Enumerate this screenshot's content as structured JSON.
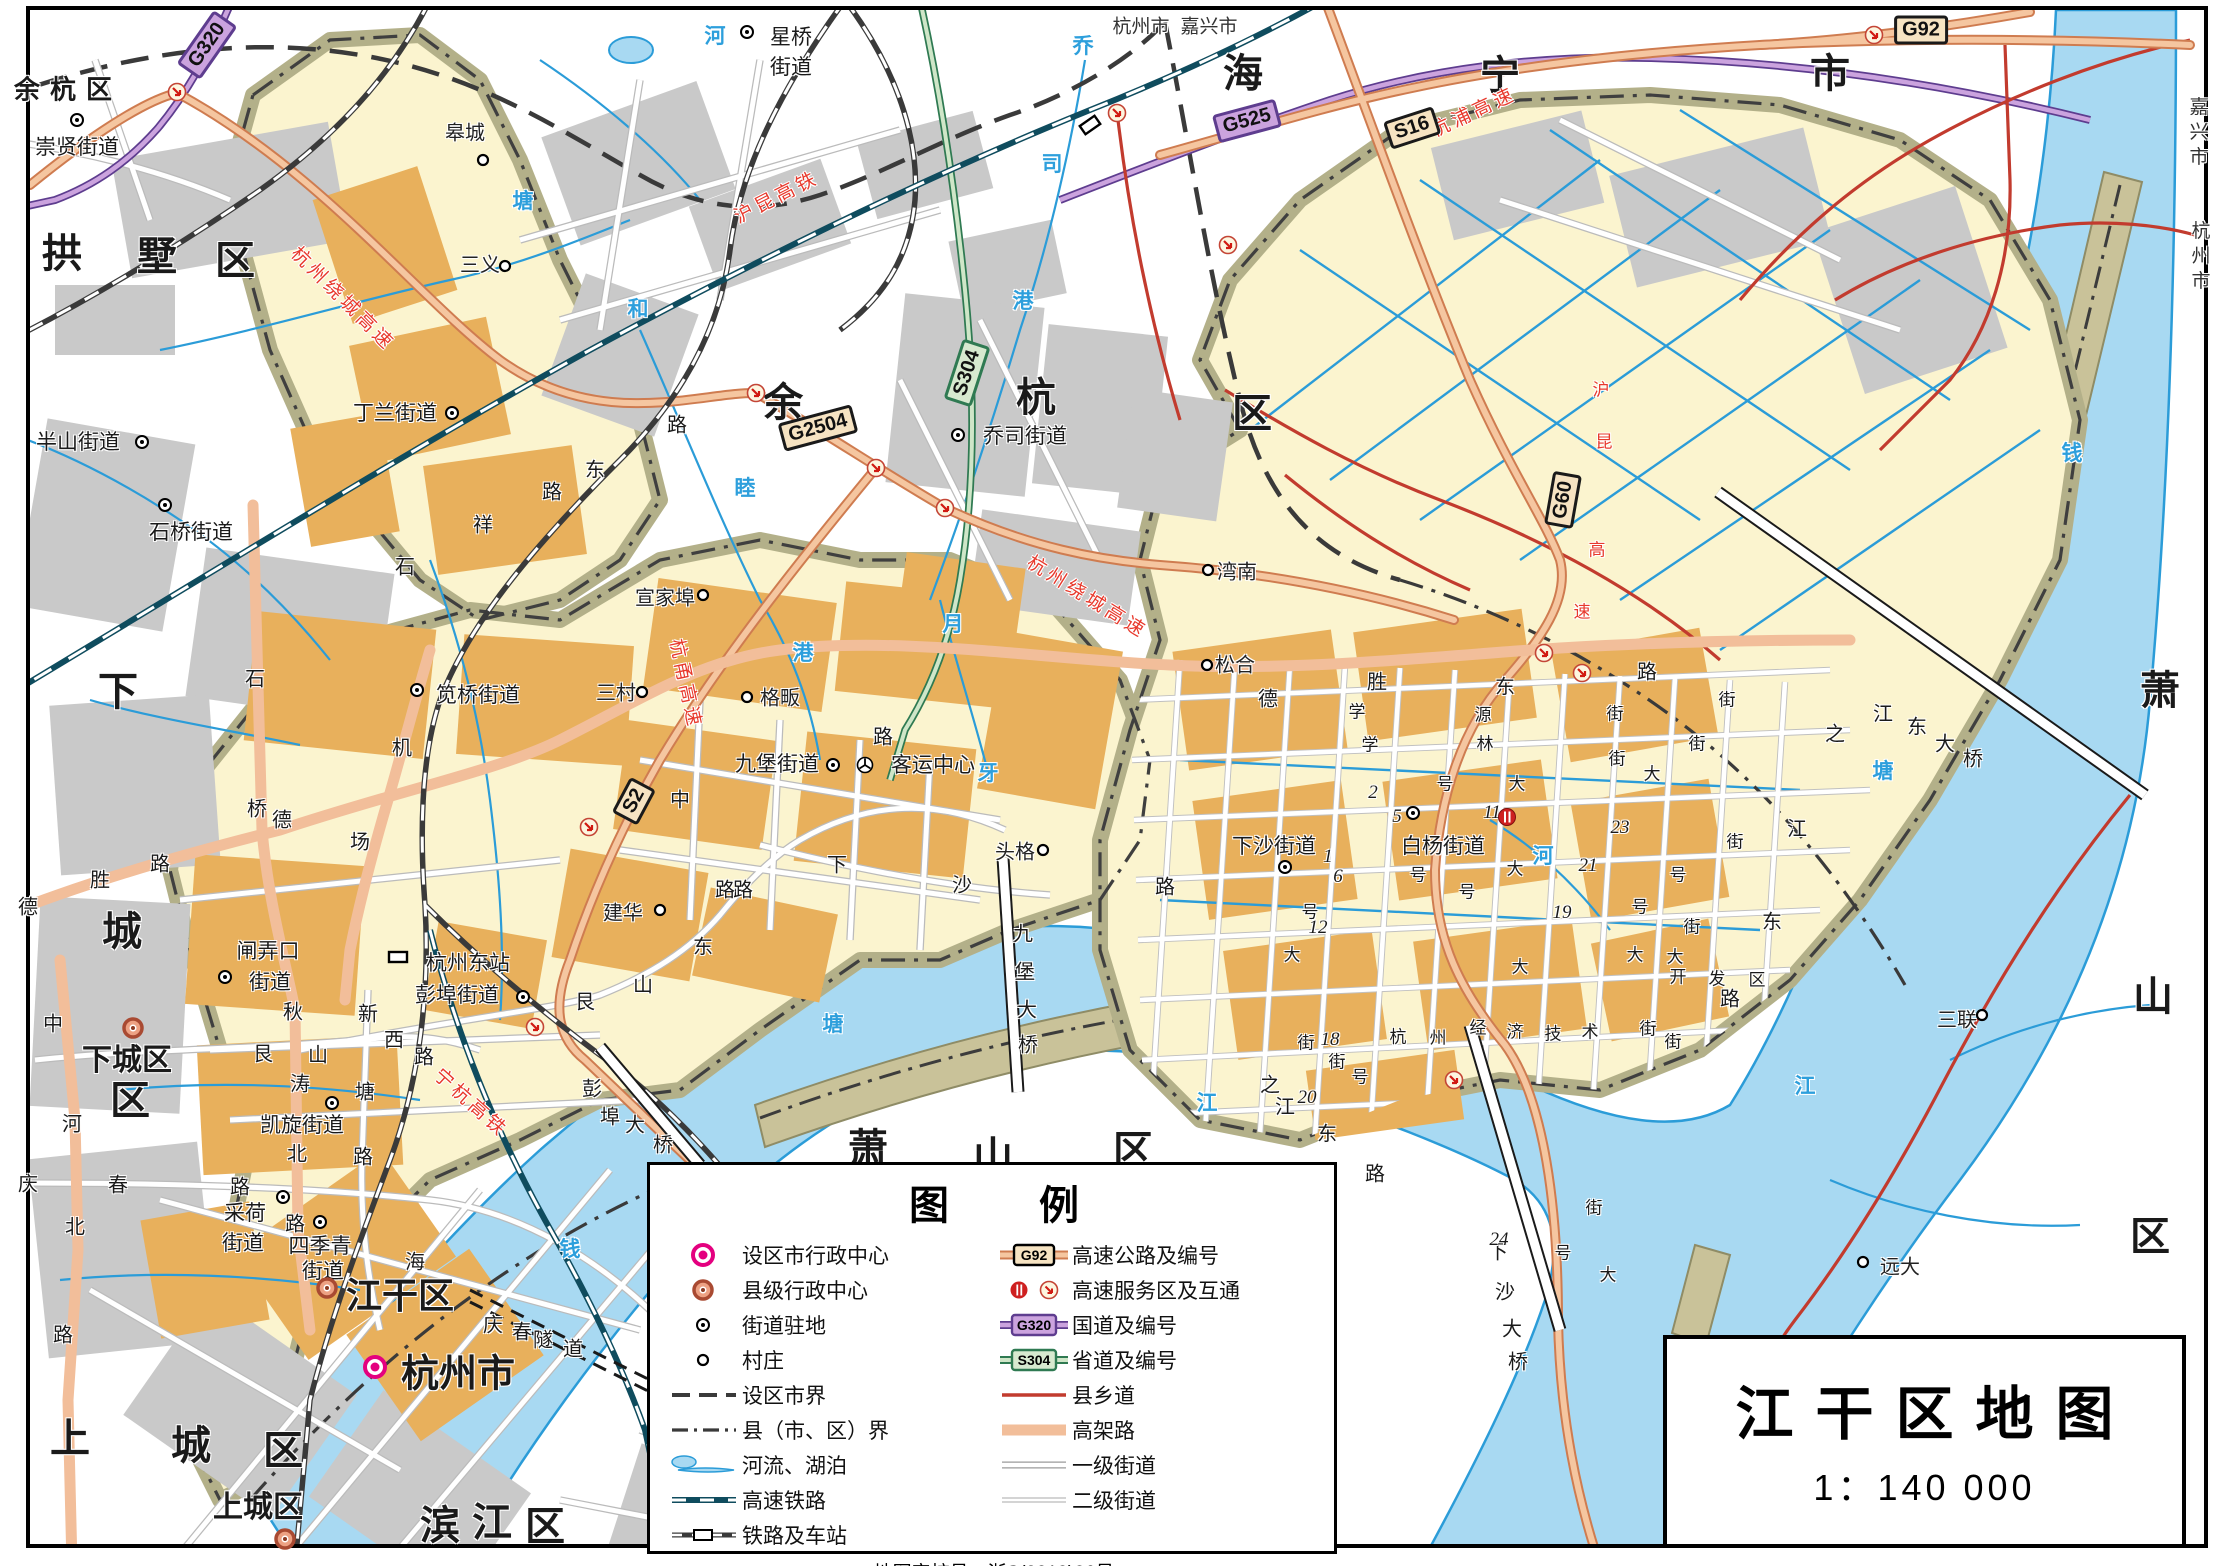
{
  "title_box": {
    "title": "江干区地图",
    "scale": "1：140 000"
  },
  "legend": {
    "title": "图例",
    "approval": "地图审核号：浙S(2019)36号",
    "left": [
      {
        "icon": "city-admin",
        "label": "设区市行政中心"
      },
      {
        "icon": "county-admin",
        "label": "县级行政中心"
      },
      {
        "icon": "subdistrict",
        "label": "街道驻地"
      },
      {
        "icon": "village",
        "label": "村庄"
      },
      {
        "icon": "city-boundary",
        "label": "设区市界"
      },
      {
        "icon": "county-boundary",
        "label": "县（市、区）界"
      },
      {
        "icon": "river",
        "label": "河流、湖泊"
      },
      {
        "icon": "hsr",
        "label": "高速铁路"
      },
      {
        "icon": "railway",
        "label": "铁路及车站"
      }
    ],
    "right": [
      {
        "icon": "expressway",
        "label": "高速公路及编号",
        "shield": "G92"
      },
      {
        "icon": "service",
        "label": "高速服务区及互通"
      },
      {
        "icon": "national",
        "label": "国道及编号",
        "shield": "G320"
      },
      {
        "icon": "provincial",
        "label": "省道及编号",
        "shield": "S304"
      },
      {
        "icon": "county-road",
        "label": "县乡道"
      },
      {
        "icon": "elevated",
        "label": "高架路"
      },
      {
        "icon": "street1",
        "label": "一级街道"
      },
      {
        "icon": "street2",
        "label": "二级街道"
      }
    ]
  },
  "shields": [
    [
      "G320",
      207,
      45,
      -55,
      "nat"
    ],
    [
      "G525",
      1247,
      121,
      -15,
      "nat"
    ],
    [
      "S16",
      1412,
      128,
      -18,
      "exp"
    ],
    [
      "G92",
      1921,
      30,
      0,
      "exp"
    ],
    [
      "G2504",
      818,
      428,
      -15,
      "exp"
    ],
    [
      "S304",
      967,
      373,
      -72,
      "prov"
    ],
    [
      "S2",
      634,
      801,
      -62,
      "exp"
    ],
    [
      "G60",
      1563,
      500,
      -80,
      "exp"
    ]
  ],
  "labels": [
    [
      "余杭区",
      68,
      88,
      "d1",
      0
    ],
    [
      "拱",
      62,
      250,
      "dch",
      0
    ],
    [
      "墅",
      157,
      253,
      "dch",
      0
    ],
    [
      "区",
      235,
      257,
      "dch",
      0
    ],
    [
      "余",
      783,
      399,
      "dch",
      0
    ],
    [
      "杭",
      1036,
      394,
      "dch",
      0
    ],
    [
      "区",
      1252,
      410,
      "dch",
      0
    ],
    [
      "海",
      1243,
      70,
      "dch",
      0
    ],
    [
      "宁",
      1500,
      72,
      "dch",
      0
    ],
    [
      "市",
      1830,
      70,
      "dch",
      0
    ],
    [
      "下",
      118,
      688,
      "dch",
      0
    ],
    [
      "城",
      122,
      928,
      "dch",
      0
    ],
    [
      "区",
      130,
      1097,
      "dch",
      0
    ],
    [
      "上",
      70,
      1435,
      "dch",
      0
    ],
    [
      "城",
      191,
      1442,
      "dch",
      0
    ],
    [
      "区",
      283,
      1447,
      "dch",
      0
    ],
    [
      "滨",
      440,
      1522,
      "dch",
      0
    ],
    [
      "江",
      492,
      1519,
      "dch",
      0
    ],
    [
      "区",
      545,
      1523,
      "dch",
      0
    ],
    [
      "萧",
      868,
      1145,
      "dch",
      0
    ],
    [
      "山",
      993,
      1153,
      "dch",
      0
    ],
    [
      "区",
      1133,
      1147,
      "dch",
      0
    ],
    [
      "萧",
      2160,
      687,
      "dch",
      0
    ],
    [
      "山",
      2153,
      993,
      "dch",
      0
    ],
    [
      "区",
      2150,
      1233,
      "dch",
      0
    ],
    [
      "杭州市",
      1141,
      25,
      "bdy",
      0
    ],
    [
      "嘉兴市",
      1209,
      25,
      "bdy",
      0
    ],
    [
      "嘉兴市",
      2197,
      134,
      "bdyv",
      0
    ],
    [
      "杭州市",
      2199,
      258,
      "bdyv",
      0
    ],
    [
      "下城区",
      127,
      1057,
      "adm28",
      0
    ],
    [
      "江干区",
      400,
      1293,
      "adm34",
      0
    ],
    [
      "杭州市",
      458,
      1370,
      "adm36",
      0
    ],
    [
      "上城区",
      258,
      1504,
      "adm28",
      0
    ],
    [
      "崇贤街道",
      77,
      146,
      "town",
      0
    ],
    [
      "星桥",
      791,
      36,
      "town",
      0
    ],
    [
      "街道",
      791,
      66,
      "town",
      0
    ],
    [
      "半山街道",
      78,
      441,
      "town",
      0
    ],
    [
      "石桥街道",
      191,
      531,
      "town",
      0
    ],
    [
      "丁兰街道",
      395,
      412,
      "town",
      0
    ],
    [
      "乔司街道",
      1025,
      435,
      "town",
      0
    ],
    [
      "笕桥街道",
      478,
      694,
      "town",
      0
    ],
    [
      "九堡街道",
      777,
      763,
      "town",
      0
    ],
    [
      "客运中心",
      933,
      764,
      "town",
      0
    ],
    [
      "杭州东站",
      468,
      962,
      "town",
      0
    ],
    [
      "彭埠街道",
      457,
      994,
      "town",
      0
    ],
    [
      "闸弄口",
      268,
      950,
      "town",
      0
    ],
    [
      "街道",
      270,
      981,
      "town",
      0
    ],
    [
      "凯旋街道",
      302,
      1124,
      "town",
      0
    ],
    [
      "采荷",
      245,
      1212,
      "town",
      0
    ],
    [
      "街道",
      243,
      1242,
      "town",
      0
    ],
    [
      "四季青",
      320,
      1245,
      "town",
      0
    ],
    [
      "街道",
      323,
      1270,
      "town",
      0
    ],
    [
      "下沙街道",
      1274,
      845,
      "town",
      0
    ],
    [
      "白杨街道",
      1443,
      845,
      "town",
      0
    ],
    [
      "皋城",
      465,
      131,
      "vill",
      0
    ],
    [
      "三义",
      480,
      263,
      "vill",
      0
    ],
    [
      "宣家埠",
      665,
      596,
      "vill",
      0
    ],
    [
      "三村",
      616,
      691,
      "vill",
      0
    ],
    [
      "格畈",
      780,
      696,
      "vill",
      0
    ],
    [
      "头格",
      1015,
      850,
      "vill",
      0
    ],
    [
      "建华",
      623,
      911,
      "vill",
      0
    ],
    [
      "湾南",
      1237,
      570,
      "vill",
      0
    ],
    [
      "松合",
      1235,
      663,
      "vill",
      0
    ],
    [
      "三联",
      1957,
      1018,
      "vill",
      0
    ],
    [
      "远大",
      1900,
      1265,
      "vill",
      0
    ],
    [
      "德",
      28,
      905,
      "road",
      0
    ],
    [
      "胜",
      100,
      878,
      "road",
      0
    ],
    [
      "路",
      160,
      862,
      "road",
      0
    ],
    [
      "石",
      255,
      677,
      "road",
      0
    ],
    [
      "桥",
      257,
      807,
      "road",
      0
    ],
    [
      "石",
      405,
      565,
      "road",
      0
    ],
    [
      "祥",
      483,
      523,
      "road",
      0
    ],
    [
      "路",
      552,
      490,
      "road",
      0
    ],
    [
      "机",
      402,
      746,
      "road",
      0
    ],
    [
      "场",
      360,
      840,
      "road",
      0
    ],
    [
      "德",
      282,
      818,
      "road",
      0
    ],
    [
      "路",
      677,
      423,
      "road",
      0
    ],
    [
      "东",
      595,
      468,
      "road",
      0
    ],
    [
      "中",
      53,
      1022,
      "road",
      0
    ],
    [
      "河",
      72,
      1122,
      "road",
      0
    ],
    [
      "北",
      75,
      1225,
      "road",
      0
    ],
    [
      "路",
      63,
      1333,
      "road",
      0
    ],
    [
      "庆",
      28,
      1182,
      "road",
      0
    ],
    [
      "春",
      118,
      1183,
      "road",
      0
    ],
    [
      "路",
      240,
      1185,
      "road",
      0
    ],
    [
      "艮",
      263,
      1052,
      "road",
      0
    ],
    [
      "山",
      318,
      1053,
      "road",
      0
    ],
    [
      "西",
      394,
      1038,
      "road",
      0
    ],
    [
      "路",
      424,
      1055,
      "road",
      0
    ],
    [
      "新",
      368,
      1012,
      "road",
      0
    ],
    [
      "塘",
      365,
      1090,
      "road",
      0
    ],
    [
      "路",
      363,
      1155,
      "road",
      0
    ],
    [
      "秋",
      293,
      1010,
      "road",
      0
    ],
    [
      "涛",
      300,
      1082,
      "road",
      0
    ],
    [
      "北",
      297,
      1152,
      "road",
      0
    ],
    [
      "路",
      295,
      1222,
      "road",
      0
    ],
    [
      "海",
      415,
      1260,
      "road",
      0
    ],
    [
      "艮",
      585,
      1000,
      "road",
      0
    ],
    [
      "山",
      643,
      983,
      "road",
      0
    ],
    [
      "东",
      703,
      945,
      "road",
      0
    ],
    [
      "路",
      743,
      888,
      "road",
      0
    ],
    [
      "中",
      680,
      798,
      "road",
      0
    ],
    [
      "路",
      725,
      888,
      "road",
      0
    ],
    [
      "路",
      883,
      735,
      "road",
      0
    ],
    [
      "下",
      837,
      863,
      "road",
      0
    ],
    [
      "沙",
      962,
      883,
      "road",
      0
    ],
    [
      "德",
      1268,
      697,
      "road",
      0
    ],
    [
      "胜",
      1377,
      680,
      "road",
      0
    ],
    [
      "东",
      1505,
      685,
      "road",
      0
    ],
    [
      "路",
      1647,
      670,
      "road",
      0
    ],
    [
      "学",
      1357,
      710,
      "rs",
      0
    ],
    [
      "源",
      1483,
      713,
      "rs",
      0
    ],
    [
      "街",
      1615,
      712,
      "rs",
      0
    ],
    [
      "学",
      1370,
      743,
      "rs",
      0
    ],
    [
      "林",
      1485,
      742,
      "rs",
      0
    ],
    [
      "街",
      1617,
      757,
      "rs",
      0
    ],
    [
      "路",
      1165,
      885,
      "road",
      0
    ],
    [
      "九",
      1023,
      932,
      "road",
      0
    ],
    [
      "堡",
      1025,
      970,
      "road",
      0
    ],
    [
      "大",
      1027,
      1008,
      "road",
      0
    ],
    [
      "桥",
      1028,
      1043,
      "road",
      0
    ],
    [
      "彭",
      592,
      1087,
      "road",
      0
    ],
    [
      "埠",
      610,
      1115,
      "road",
      0
    ],
    [
      "大",
      635,
      1123,
      "road",
      0
    ],
    [
      "桥",
      663,
      1143,
      "road",
      0
    ],
    [
      "庆",
      493,
      1323,
      "road",
      0
    ],
    [
      "春",
      522,
      1330,
      "road",
      0
    ],
    [
      "隧",
      543,
      1338,
      "road",
      0
    ],
    [
      "道",
      573,
      1347,
      "road",
      0
    ],
    [
      "下",
      1498,
      1250,
      "road",
      0
    ],
    [
      "沙",
      1505,
      1290,
      "road",
      0
    ],
    [
      "大",
      1512,
      1327,
      "road",
      0
    ],
    [
      "桥",
      1518,
      1360,
      "road",
      0
    ],
    [
      "江",
      1883,
      712,
      "road",
      0
    ],
    [
      "东",
      1917,
      725,
      "road",
      0
    ],
    [
      "大",
      1945,
      742,
      "road",
      0
    ],
    [
      "桥",
      1973,
      757,
      "road",
      0
    ],
    [
      "之",
      1270,
      1083,
      "road",
      0
    ],
    [
      "江",
      1285,
      1105,
      "road",
      0
    ],
    [
      "东",
      1327,
      1132,
      "road",
      0
    ],
    [
      "路",
      1375,
      1172,
      "road",
      0
    ],
    [
      "之",
      1835,
      732,
      "road",
      0
    ],
    [
      "江",
      1797,
      827,
      "road",
      0
    ],
    [
      "东",
      1772,
      920,
      "road",
      0
    ],
    [
      "路",
      1730,
      997,
      "road",
      0
    ],
    [
      "杭",
      1398,
      1035,
      "rs",
      0
    ],
    [
      "州",
      1438,
      1036,
      "rs",
      0
    ],
    [
      "经",
      1478,
      1026,
      "rs",
      0
    ],
    [
      "济",
      1515,
      1030,
      "rs",
      0
    ],
    [
      "技",
      1553,
      1032,
      "rs",
      0
    ],
    [
      "术",
      1590,
      1030,
      "rs",
      0
    ],
    [
      "开",
      1678,
      975,
      "rs",
      0
    ],
    [
      "发",
      1717,
      977,
      "rs",
      0
    ],
    [
      "区",
      1757,
      978,
      "rs",
      0
    ],
    [
      "2",
      1373,
      793,
      "num",
      0
    ],
    [
      "5",
      1397,
      817,
      "num",
      0
    ],
    [
      "1",
      1328,
      857,
      "num",
      0
    ],
    [
      "6",
      1338,
      877,
      "num",
      0
    ],
    [
      "11",
      1492,
      813,
      "num",
      0
    ],
    [
      "12",
      1318,
      928,
      "num",
      0
    ],
    [
      "18",
      1330,
      1040,
      "num",
      0
    ],
    [
      "19",
      1562,
      913,
      "num",
      0
    ],
    [
      "20",
      1307,
      1098,
      "num",
      0
    ],
    [
      "21",
      1588,
      866,
      "num",
      0
    ],
    [
      "23",
      1620,
      828,
      "num",
      0
    ],
    [
      "24",
      1499,
      1240,
      "num",
      0
    ],
    [
      "号",
      1445,
      782,
      "rs",
      0
    ],
    [
      "大",
      1517,
      782,
      "rs",
      0
    ],
    [
      "号",
      1418,
      873,
      "rs",
      0
    ],
    [
      "号",
      1467,
      890,
      "rs",
      0
    ],
    [
      "大",
      1515,
      867,
      "rs",
      0
    ],
    [
      "号",
      1310,
      910,
      "rs",
      0
    ],
    [
      "大",
      1292,
      953,
      "rs",
      0
    ],
    [
      "大",
      1520,
      965,
      "rs",
      0
    ],
    [
      "街",
      1306,
      1041,
      "rs",
      0
    ],
    [
      "街",
      1337,
      1060,
      "rs",
      0
    ],
    [
      "号",
      1360,
      1075,
      "rs",
      0
    ],
    [
      "大",
      1652,
      772,
      "rs",
      0
    ],
    [
      "街",
      1727,
      698,
      "rs",
      0
    ],
    [
      "街",
      1697,
      742,
      "rs",
      0
    ],
    [
      "街",
      1735,
      840,
      "rs",
      0
    ],
    [
      "号",
      1678,
      873,
      "rs",
      0
    ],
    [
      "号",
      1640,
      905,
      "rs",
      0
    ],
    [
      "街",
      1692,
      925,
      "rs",
      0
    ],
    [
      "大",
      1635,
      953,
      "rs",
      0
    ],
    [
      "大",
      1675,
      955,
      "rs",
      0
    ],
    [
      "街",
      1648,
      1027,
      "rs",
      0
    ],
    [
      "街",
      1673,
      1040,
      "rs",
      0
    ],
    [
      "号",
      1563,
      1251,
      "rs",
      0
    ],
    [
      "大",
      1608,
      1273,
      "rs",
      0
    ],
    [
      "街",
      1594,
      1206,
      "rs",
      0
    ],
    [
      "河",
      715,
      35,
      "wat",
      0
    ],
    [
      "乔",
      1083,
      45,
      "wat",
      0
    ],
    [
      "司",
      1052,
      163,
      "wat",
      0
    ],
    [
      "港",
      1023,
      300,
      "wat",
      0
    ],
    [
      "塘",
      523,
      200,
      "wat",
      0
    ],
    [
      "和",
      638,
      308,
      "wat",
      0
    ],
    [
      "睦",
      745,
      487,
      "wat",
      0
    ],
    [
      "港",
      803,
      652,
      "wat",
      0
    ],
    [
      "月",
      953,
      623,
      "wat",
      0
    ],
    [
      "牙",
      988,
      772,
      "wat",
      0
    ],
    [
      "河",
      1543,
      855,
      "wat",
      0
    ],
    [
      "钱",
      570,
      1248,
      "wat",
      0
    ],
    [
      "塘",
      833,
      1023,
      "wat",
      0
    ],
    [
      "江",
      1207,
      1102,
      "wat",
      0
    ],
    [
      "钱",
      2072,
      452,
      "wat",
      0
    ],
    [
      "塘",
      1883,
      770,
      "wat",
      0
    ],
    [
      "江",
      1805,
      1085,
      "wat",
      0
    ],
    [
      "杭州绕城高速",
      344,
      298,
      "redl",
      45
    ],
    [
      "杭甬高速",
      687,
      684,
      "redl",
      78
    ],
    [
      "杭州绕城高速",
      1088,
      596,
      "redl",
      32
    ],
    [
      "沪昆高铁",
      776,
      196,
      "redl",
      -27
    ],
    [
      "宁杭高铁",
      472,
      1102,
      "redl",
      42
    ],
    [
      "杭浦高速",
      1473,
      111,
      "redl",
      -25
    ],
    [
      "沪",
      1601,
      388,
      "red",
      0
    ],
    [
      "昆",
      1604,
      440,
      "red",
      0
    ],
    [
      "高",
      1597,
      548,
      "red",
      0
    ],
    [
      "速",
      1582,
      610,
      "red",
      0
    ]
  ],
  "markers": [
    [
      "city",
      375,
      1367,
      0
    ],
    [
      "county",
      133,
      1028,
      0
    ],
    [
      "county",
      327,
      1288,
      0
    ],
    [
      "county",
      285,
      1539,
      0
    ],
    [
      "town",
      77,
      120,
      0
    ],
    [
      "town",
      747,
      32,
      0
    ],
    [
      "town",
      142,
      442,
      0
    ],
    [
      "town",
      165,
      505,
      0
    ],
    [
      "town",
      452,
      413,
      0
    ],
    [
      "town",
      958,
      435,
      0
    ],
    [
      "town",
      417,
      690,
      0
    ],
    [
      "town",
      833,
      765,
      0
    ],
    [
      "town",
      523,
      997,
      0
    ],
    [
      "town",
      225,
      977,
      0
    ],
    [
      "town",
      332,
      1103,
      0
    ],
    [
      "town",
      283,
      1197,
      0
    ],
    [
      "town",
      320,
      1222,
      0
    ],
    [
      "town",
      1285,
      867,
      0
    ],
    [
      "town",
      1413,
      813,
      0
    ],
    [
      "village",
      483,
      160,
      0
    ],
    [
      "village",
      505,
      266,
      0
    ],
    [
      "village",
      703,
      595,
      0
    ],
    [
      "village",
      642,
      692,
      0
    ],
    [
      "village",
      747,
      697,
      0
    ],
    [
      "village",
      1043,
      850,
      0
    ],
    [
      "village",
      660,
      910,
      0
    ],
    [
      "village",
      1208,
      570,
      0
    ],
    [
      "village",
      1207,
      665,
      0
    ],
    [
      "village",
      1982,
      1015,
      0
    ],
    [
      "village",
      1863,
      1262,
      0
    ],
    [
      "inter",
      177,
      92,
      0
    ],
    [
      "inter",
      756,
      393,
      0
    ],
    [
      "inter",
      876,
      468,
      0
    ],
    [
      "inter",
      945,
      508,
      0
    ],
    [
      "inter",
      589,
      827,
      0
    ],
    [
      "inter",
      1544,
      653,
      0
    ],
    [
      "inter",
      1582,
      673,
      0
    ],
    [
      "inter",
      535,
      1027,
      0
    ],
    [
      "inter",
      1454,
      1080,
      0
    ],
    [
      "inter",
      1874,
      35,
      0
    ],
    [
      "inter",
      1117,
      113,
      0
    ],
    [
      "inter",
      1228,
      245,
      0
    ],
    [
      "service",
      1507,
      817,
      0
    ],
    [
      "station",
      398,
      957,
      0
    ],
    [
      "station",
      1090,
      125,
      -35
    ],
    [
      "bus",
      865,
      765,
      0
    ]
  ]
}
